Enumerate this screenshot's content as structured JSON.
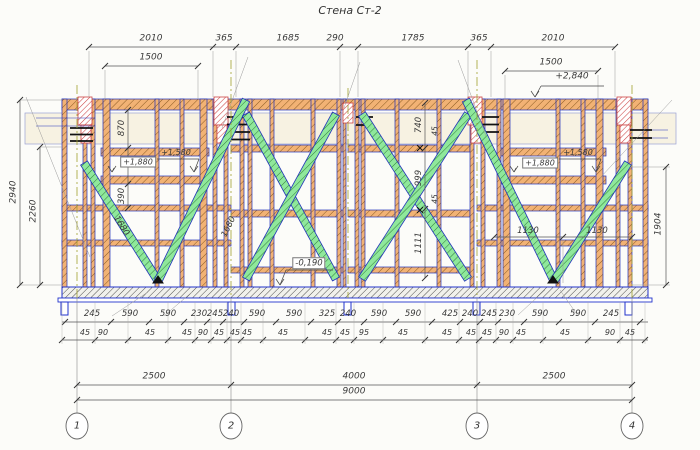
{
  "title": "Стена Ст-2",
  "colors": {
    "member_blue": "#2233bb",
    "wood_orange": "#f2b274",
    "brace_green": "#8fe89b",
    "post_red": "#cc4444",
    "beam_cream": "#f7f2e2",
    "dim_gray": "#3a3a3a"
  },
  "grid_bubbles": {
    "cy": 426,
    "items": [
      {
        "label": "1",
        "x": 77
      },
      {
        "label": "2",
        "x": 231
      },
      {
        "label": "3",
        "x": 477
      },
      {
        "label": "4",
        "x": 632
      }
    ]
  },
  "labels": [
    {
      "t": "2010",
      "x": 151,
      "y": 39,
      "s": 9
    },
    {
      "t": "365",
      "x": 224,
      "y": 39,
      "s": 9
    },
    {
      "t": "1685",
      "x": 288,
      "y": 39,
      "s": 9
    },
    {
      "t": "290",
      "x": 335,
      "y": 39,
      "s": 9
    },
    {
      "t": "1785",
      "x": 413,
      "y": 39,
      "s": 9
    },
    {
      "t": "365",
      "x": 479,
      "y": 39,
      "s": 9
    },
    {
      "t": "2010",
      "x": 553,
      "y": 39,
      "s": 9
    },
    {
      "t": "1500",
      "x": 151,
      "y": 58,
      "s": 9
    },
    {
      "t": "1500",
      "x": 551,
      "y": 63,
      "s": 9
    },
    {
      "t": "+2,840",
      "x": 572,
      "y": 77,
      "s": 9
    },
    {
      "t": "2940",
      "x": 14,
      "y": 192,
      "r": -90,
      "s": 9
    },
    {
      "t": "2260",
      "x": 34,
      "y": 211,
      "r": -90,
      "s": 9
    },
    {
      "t": "1904",
      "x": 659,
      "y": 224,
      "r": -90,
      "s": 9
    },
    {
      "t": "870",
      "x": 122,
      "y": 128,
      "r": -90,
      "s": 8.5
    },
    {
      "t": "390",
      "x": 122,
      "y": 196,
      "r": -90,
      "s": 8.5
    },
    {
      "t": "740",
      "x": 419,
      "y": 125,
      "r": -90,
      "s": 8.5
    },
    {
      "t": "999",
      "x": 419,
      "y": 178,
      "r": -90,
      "s": 8.5
    },
    {
      "t": "1111",
      "x": 419,
      "y": 243,
      "r": -90,
      "s": 8.5
    },
    {
      "t": "45",
      "x": 435,
      "y": 131,
      "r": -90,
      "s": 7.5
    },
    {
      "t": "45",
      "x": 435,
      "y": 199,
      "r": -90,
      "s": 7.5
    },
    {
      "t": "1680",
      "x": 121,
      "y": 226,
      "r": 58,
      "s": 8.5
    },
    {
      "t": "1680",
      "x": 229,
      "y": 227,
      "r": -64,
      "s": 8.5
    },
    {
      "t": "1130",
      "x": 528,
      "y": 231,
      "s": 8.5
    },
    {
      "t": "1130",
      "x": 597,
      "y": 231,
      "s": 8.5
    },
    {
      "t": "+1,880",
      "x": 138,
      "y": 162,
      "s": 8,
      "b": 1
    },
    {
      "t": "+1,580",
      "x": 176,
      "y": 153,
      "s": 8
    },
    {
      "t": "+1,880",
      "x": 540,
      "y": 163,
      "s": 8,
      "b": 1
    },
    {
      "t": "+1,580",
      "x": 578,
      "y": 153,
      "s": 8
    },
    {
      "t": "-0,190",
      "x": 309,
      "y": 263,
      "s": 8.5,
      "b": 1
    },
    {
      "t": "2500",
      "x": 154,
      "y": 377,
      "s": 9
    },
    {
      "t": "4000",
      "x": 354,
      "y": 377,
      "s": 9
    },
    {
      "t": "2500",
      "x": 554,
      "y": 377,
      "s": 9
    },
    {
      "t": "9000",
      "x": 354,
      "y": 392,
      "s": 9
    },
    {
      "t": "245",
      "x": 92,
      "y": 314,
      "s": 8.5
    },
    {
      "t": "590",
      "x": 130,
      "y": 314,
      "s": 8.5
    },
    {
      "t": "590",
      "x": 168,
      "y": 314,
      "s": 8.5
    },
    {
      "t": "230",
      "x": 199,
      "y": 314,
      "s": 8.5
    },
    {
      "t": "245",
      "x": 215,
      "y": 314,
      "s": 8.5
    },
    {
      "t": "240",
      "x": 231,
      "y": 314,
      "s": 8.5
    },
    {
      "t": "590",
      "x": 257,
      "y": 314,
      "s": 8.5
    },
    {
      "t": "590",
      "x": 294,
      "y": 314,
      "s": 8.5
    },
    {
      "t": "325",
      "x": 327,
      "y": 314,
      "s": 8.5
    },
    {
      "t": "240",
      "x": 348,
      "y": 314,
      "s": 8.5
    },
    {
      "t": "590",
      "x": 379,
      "y": 314,
      "s": 8.5
    },
    {
      "t": "590",
      "x": 413,
      "y": 314,
      "s": 8.5
    },
    {
      "t": "425",
      "x": 450,
      "y": 314,
      "s": 8.5
    },
    {
      "t": "240",
      "x": 470,
      "y": 314,
      "s": 8.5
    },
    {
      "t": "245",
      "x": 489,
      "y": 314,
      "s": 8.5
    },
    {
      "t": "230",
      "x": 507,
      "y": 314,
      "s": 8.5
    },
    {
      "t": "590",
      "x": 540,
      "y": 314,
      "s": 8.5
    },
    {
      "t": "590",
      "x": 578,
      "y": 314,
      "s": 8.5
    },
    {
      "t": "245",
      "x": 611,
      "y": 314,
      "s": 8.5
    },
    {
      "t": "45",
      "x": 85,
      "y": 333,
      "s": 8
    },
    {
      "t": "90",
      "x": 103,
      "y": 333,
      "s": 8
    },
    {
      "t": "45",
      "x": 150,
      "y": 333,
      "s": 8
    },
    {
      "t": "45",
      "x": 187,
      "y": 333,
      "s": 8
    },
    {
      "t": "90",
      "x": 203,
      "y": 333,
      "s": 8
    },
    {
      "t": "45",
      "x": 219,
      "y": 333,
      "s": 8
    },
    {
      "t": "45",
      "x": 235,
      "y": 333,
      "s": 8
    },
    {
      "t": "45",
      "x": 247,
      "y": 333,
      "s": 8
    },
    {
      "t": "45",
      "x": 283,
      "y": 333,
      "s": 8
    },
    {
      "t": "45",
      "x": 327,
      "y": 333,
      "s": 8
    },
    {
      "t": "45",
      "x": 345,
      "y": 333,
      "s": 8
    },
    {
      "t": "95",
      "x": 364,
      "y": 333,
      "s": 8
    },
    {
      "t": "45",
      "x": 403,
      "y": 333,
      "s": 8
    },
    {
      "t": "45",
      "x": 447,
      "y": 333,
      "s": 8
    },
    {
      "t": "45",
      "x": 471,
      "y": 333,
      "s": 8
    },
    {
      "t": "45",
      "x": 487,
      "y": 333,
      "s": 8
    },
    {
      "t": "90",
      "x": 504,
      "y": 333,
      "s": 8
    },
    {
      "t": "45",
      "x": 521,
      "y": 333,
      "s": 8
    },
    {
      "t": "45",
      "x": 565,
      "y": 333,
      "s": 8
    },
    {
      "t": "90",
      "x": 610,
      "y": 333,
      "s": 8
    },
    {
      "t": "45",
      "x": 630,
      "y": 333,
      "s": 8
    }
  ],
  "tick_rows": [
    {
      "y": 47,
      "xs": [
        89,
        213,
        236,
        340,
        358,
        468,
        491,
        615
      ]
    },
    {
      "y": 66,
      "xs": [
        105,
        198
      ]
    },
    {
      "y": 71,
      "xs": [
        505,
        598
      ]
    },
    {
      "y": 237,
      "xs": [
        494,
        563,
        632
      ]
    },
    {
      "y": 322,
      "xs": [
        65,
        111,
        149,
        184,
        207,
        223,
        244,
        276,
        311,
        338,
        364,
        396,
        432,
        460,
        480,
        498,
        524,
        559,
        595,
        640
      ]
    },
    {
      "y": 340,
      "xs": [
        62,
        95,
        128,
        168,
        195,
        211,
        227,
        241,
        263,
        305,
        336,
        354,
        383,
        425,
        459,
        479,
        496,
        513,
        543,
        588,
        620,
        645
      ]
    },
    {
      "y": 385,
      "xs": [
        77,
        231,
        477,
        632
      ]
    },
    {
      "y": 400,
      "xs": [
        77,
        632
      ]
    }
  ],
  "tick_cols": [
    {
      "x": 20,
      "ys": [
        100,
        285
      ]
    },
    {
      "x": 40,
      "ys": [
        147,
        285
      ]
    },
    {
      "x": 666,
      "ys": [
        167,
        285
      ]
    },
    {
      "x": 128,
      "ys": [
        110,
        148,
        184,
        208
      ]
    },
    {
      "x": 425,
      "ys": [
        103,
        148,
        209,
        278
      ]
    }
  ],
  "ext_verticals": {
    "y1": 302,
    "y2": 344,
    "xs": [
      62,
      95,
      128,
      168,
      195,
      211,
      227,
      241,
      263,
      305,
      336,
      354,
      383,
      425,
      459,
      479,
      496,
      513,
      543,
      588,
      620,
      645
    ]
  }
}
